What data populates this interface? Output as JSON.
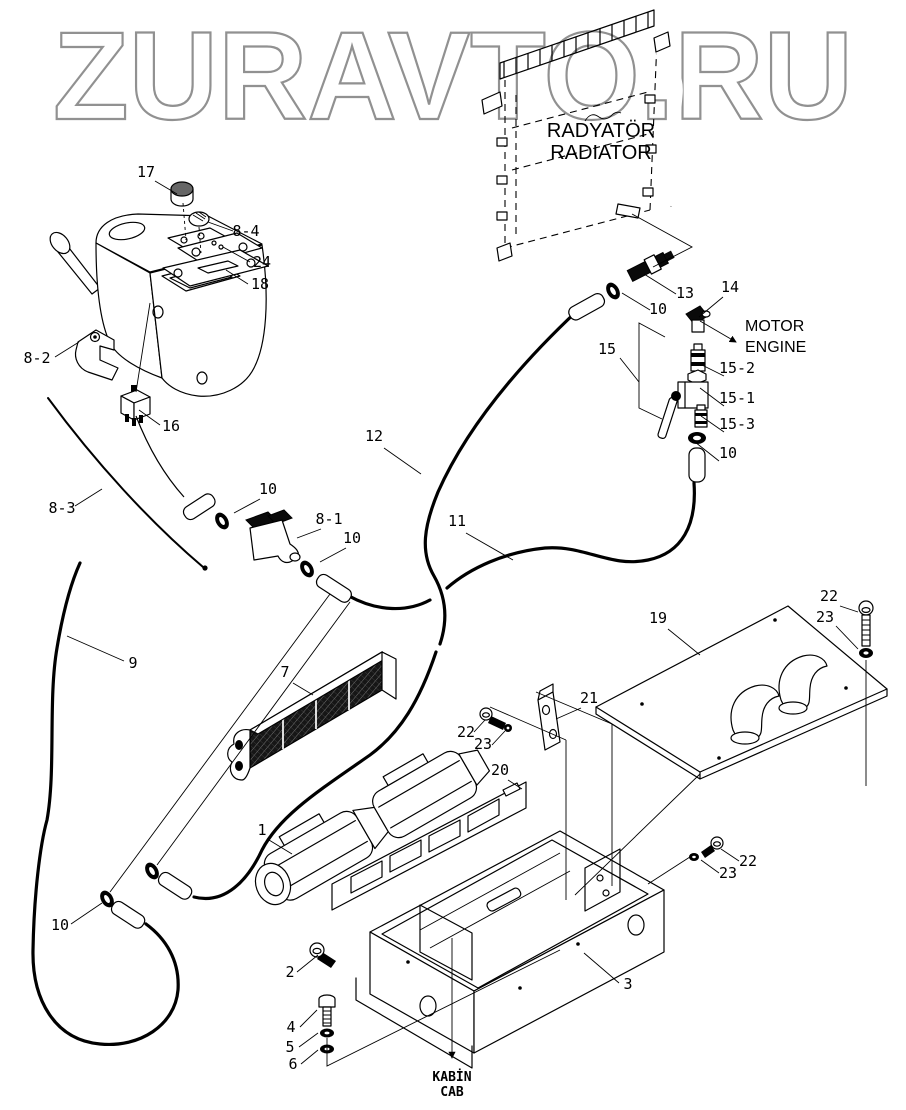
{
  "watermark": "ZURAVTO.RU",
  "colors": {
    "ink": "#000000",
    "paper": "#ffffff",
    "watermark_outline": "#919191"
  },
  "labels": {
    "radiator_tr": "RADYATÖR",
    "radiator_en": "RADIATOR",
    "engine_tr": "MOTOR",
    "engine_en": "ENGINE",
    "cab_tr": "KABİN",
    "cab_en": "CAB"
  },
  "callouts": [
    {
      "id": "17",
      "label": "17",
      "x": 146,
      "y": 177
    },
    {
      "id": "8-4",
      "label": "8-4",
      "x": 246,
      "y": 236
    },
    {
      "id": "24",
      "label": "24",
      "x": 262,
      "y": 267
    },
    {
      "id": "18",
      "label": "18",
      "x": 260,
      "y": 289
    },
    {
      "id": "8-2",
      "label": "8-2",
      "x": 37,
      "y": 363
    },
    {
      "id": "16",
      "label": "16",
      "x": 171,
      "y": 431
    },
    {
      "id": "12",
      "label": "12",
      "x": 374,
      "y": 441
    },
    {
      "id": "8-3",
      "label": "8-3",
      "x": 62,
      "y": 513
    },
    {
      "id": "10-mid",
      "label": "10",
      "x": 268,
      "y": 494
    },
    {
      "id": "8-1",
      "label": "8-1",
      "x": 329,
      "y": 524
    },
    {
      "id": "10-valve",
      "label": "10",
      "x": 352,
      "y": 543
    },
    {
      "id": "11",
      "label": "11",
      "x": 457,
      "y": 526
    },
    {
      "id": "9",
      "label": "9",
      "x": 133,
      "y": 668
    },
    {
      "id": "7",
      "label": "7",
      "x": 285,
      "y": 677
    },
    {
      "id": "13",
      "label": "13",
      "x": 685,
      "y": 298
    },
    {
      "id": "10-top",
      "label": "10",
      "x": 658,
      "y": 314
    },
    {
      "id": "14",
      "label": "14",
      "x": 730,
      "y": 292
    },
    {
      "id": "15",
      "label": "15",
      "x": 607,
      "y": 354
    },
    {
      "id": "15-2",
      "label": "15-2",
      "x": 737,
      "y": 373
    },
    {
      "id": "15-1",
      "label": "15-1",
      "x": 737,
      "y": 403
    },
    {
      "id": "15-3",
      "label": "15-3",
      "x": 737,
      "y": 429
    },
    {
      "id": "10-chain",
      "label": "10",
      "x": 728,
      "y": 458
    },
    {
      "id": "19",
      "label": "19",
      "x": 658,
      "y": 623
    },
    {
      "id": "22-top",
      "label": "22",
      "x": 829,
      "y": 601
    },
    {
      "id": "23-top",
      "label": "23",
      "x": 825,
      "y": 622
    },
    {
      "id": "21",
      "label": "21",
      "x": 589,
      "y": 703
    },
    {
      "id": "22-left",
      "label": "22",
      "x": 466,
      "y": 737
    },
    {
      "id": "23-left",
      "label": "23",
      "x": 483,
      "y": 749
    },
    {
      "id": "20",
      "label": "20",
      "x": 500,
      "y": 775
    },
    {
      "id": "1",
      "label": "1",
      "x": 262,
      "y": 835
    },
    {
      "id": "22-right",
      "label": "22",
      "x": 748,
      "y": 866
    },
    {
      "id": "23-right",
      "label": "23",
      "x": 728,
      "y": 878
    },
    {
      "id": "2",
      "label": "2",
      "x": 290,
      "y": 977
    },
    {
      "id": "3",
      "label": "3",
      "x": 628,
      "y": 989
    },
    {
      "id": "4",
      "label": "4",
      "x": 291,
      "y": 1032
    },
    {
      "id": "5",
      "label": "5",
      "x": 290,
      "y": 1052
    },
    {
      "id": "6",
      "label": "6",
      "x": 293,
      "y": 1069
    },
    {
      "id": "10-bottom",
      "label": "10",
      "x": 60,
      "y": 930
    }
  ]
}
